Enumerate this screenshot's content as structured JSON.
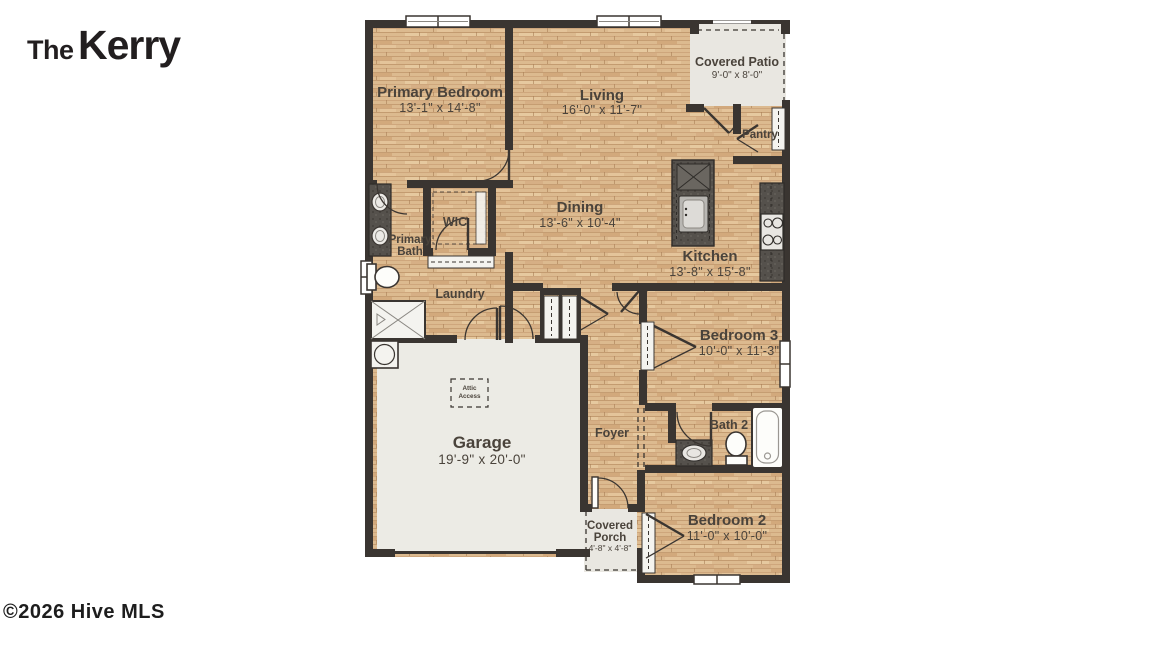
{
  "page": {
    "title_prefix": "The",
    "title": "Kerry",
    "copyright": "©2026 Hive MLS"
  },
  "legend": {
    "title_line1": "Flooring",
    "title_line2": "Legend",
    "items": [
      {
        "label": "Vinyl",
        "swatch_color": "#d8b58a"
      }
    ]
  },
  "rooms": {
    "primary_bedroom": {
      "name": "Primary Bedroom",
      "dims": "13'-1\" x 14'-8\""
    },
    "living": {
      "name": "Living",
      "dims": "16'-0\" x 11'-7\""
    },
    "covered_patio": {
      "name": "Covered Patio",
      "dims": "9'-0\" x 8'-0\""
    },
    "pantry": {
      "name": "Pantry"
    },
    "dining": {
      "name": "Dining",
      "dims": "13'-6\" x 10'-4\""
    },
    "kitchen": {
      "name": "Kitchen",
      "dims": "13'-8\" x 15'-8\""
    },
    "wic": {
      "name": "WIC"
    },
    "primary_bath": {
      "name_line1": "Primary",
      "name_line2": "Bath"
    },
    "laundry": {
      "name": "Laundry"
    },
    "garage": {
      "name": "Garage",
      "dims": "19'-9\" x 20'-0\""
    },
    "attic_access": {
      "line1": "Attic",
      "line2": "Access"
    },
    "foyer": {
      "name": "Foyer"
    },
    "bedroom3": {
      "name": "Bedroom 3",
      "dims": "10'-0\" x 11'-3\""
    },
    "bath2": {
      "name": "Bath 2"
    },
    "bedroom2": {
      "name": "Bedroom 2",
      "dims": "11'-0\" x 10'-0\""
    },
    "covered_porch": {
      "name_line1": "Covered",
      "name_line2": "Porch",
      "dims": "4'-8\" x 4'-8\""
    }
  },
  "colors": {
    "wall": "#3a3531",
    "wood_floor": "#dcba8f",
    "concrete_floor": "#ecebe5",
    "counter": "#55514c",
    "label_text": "#4a433b",
    "vinyl_swatch": "#d8b58a"
  }
}
